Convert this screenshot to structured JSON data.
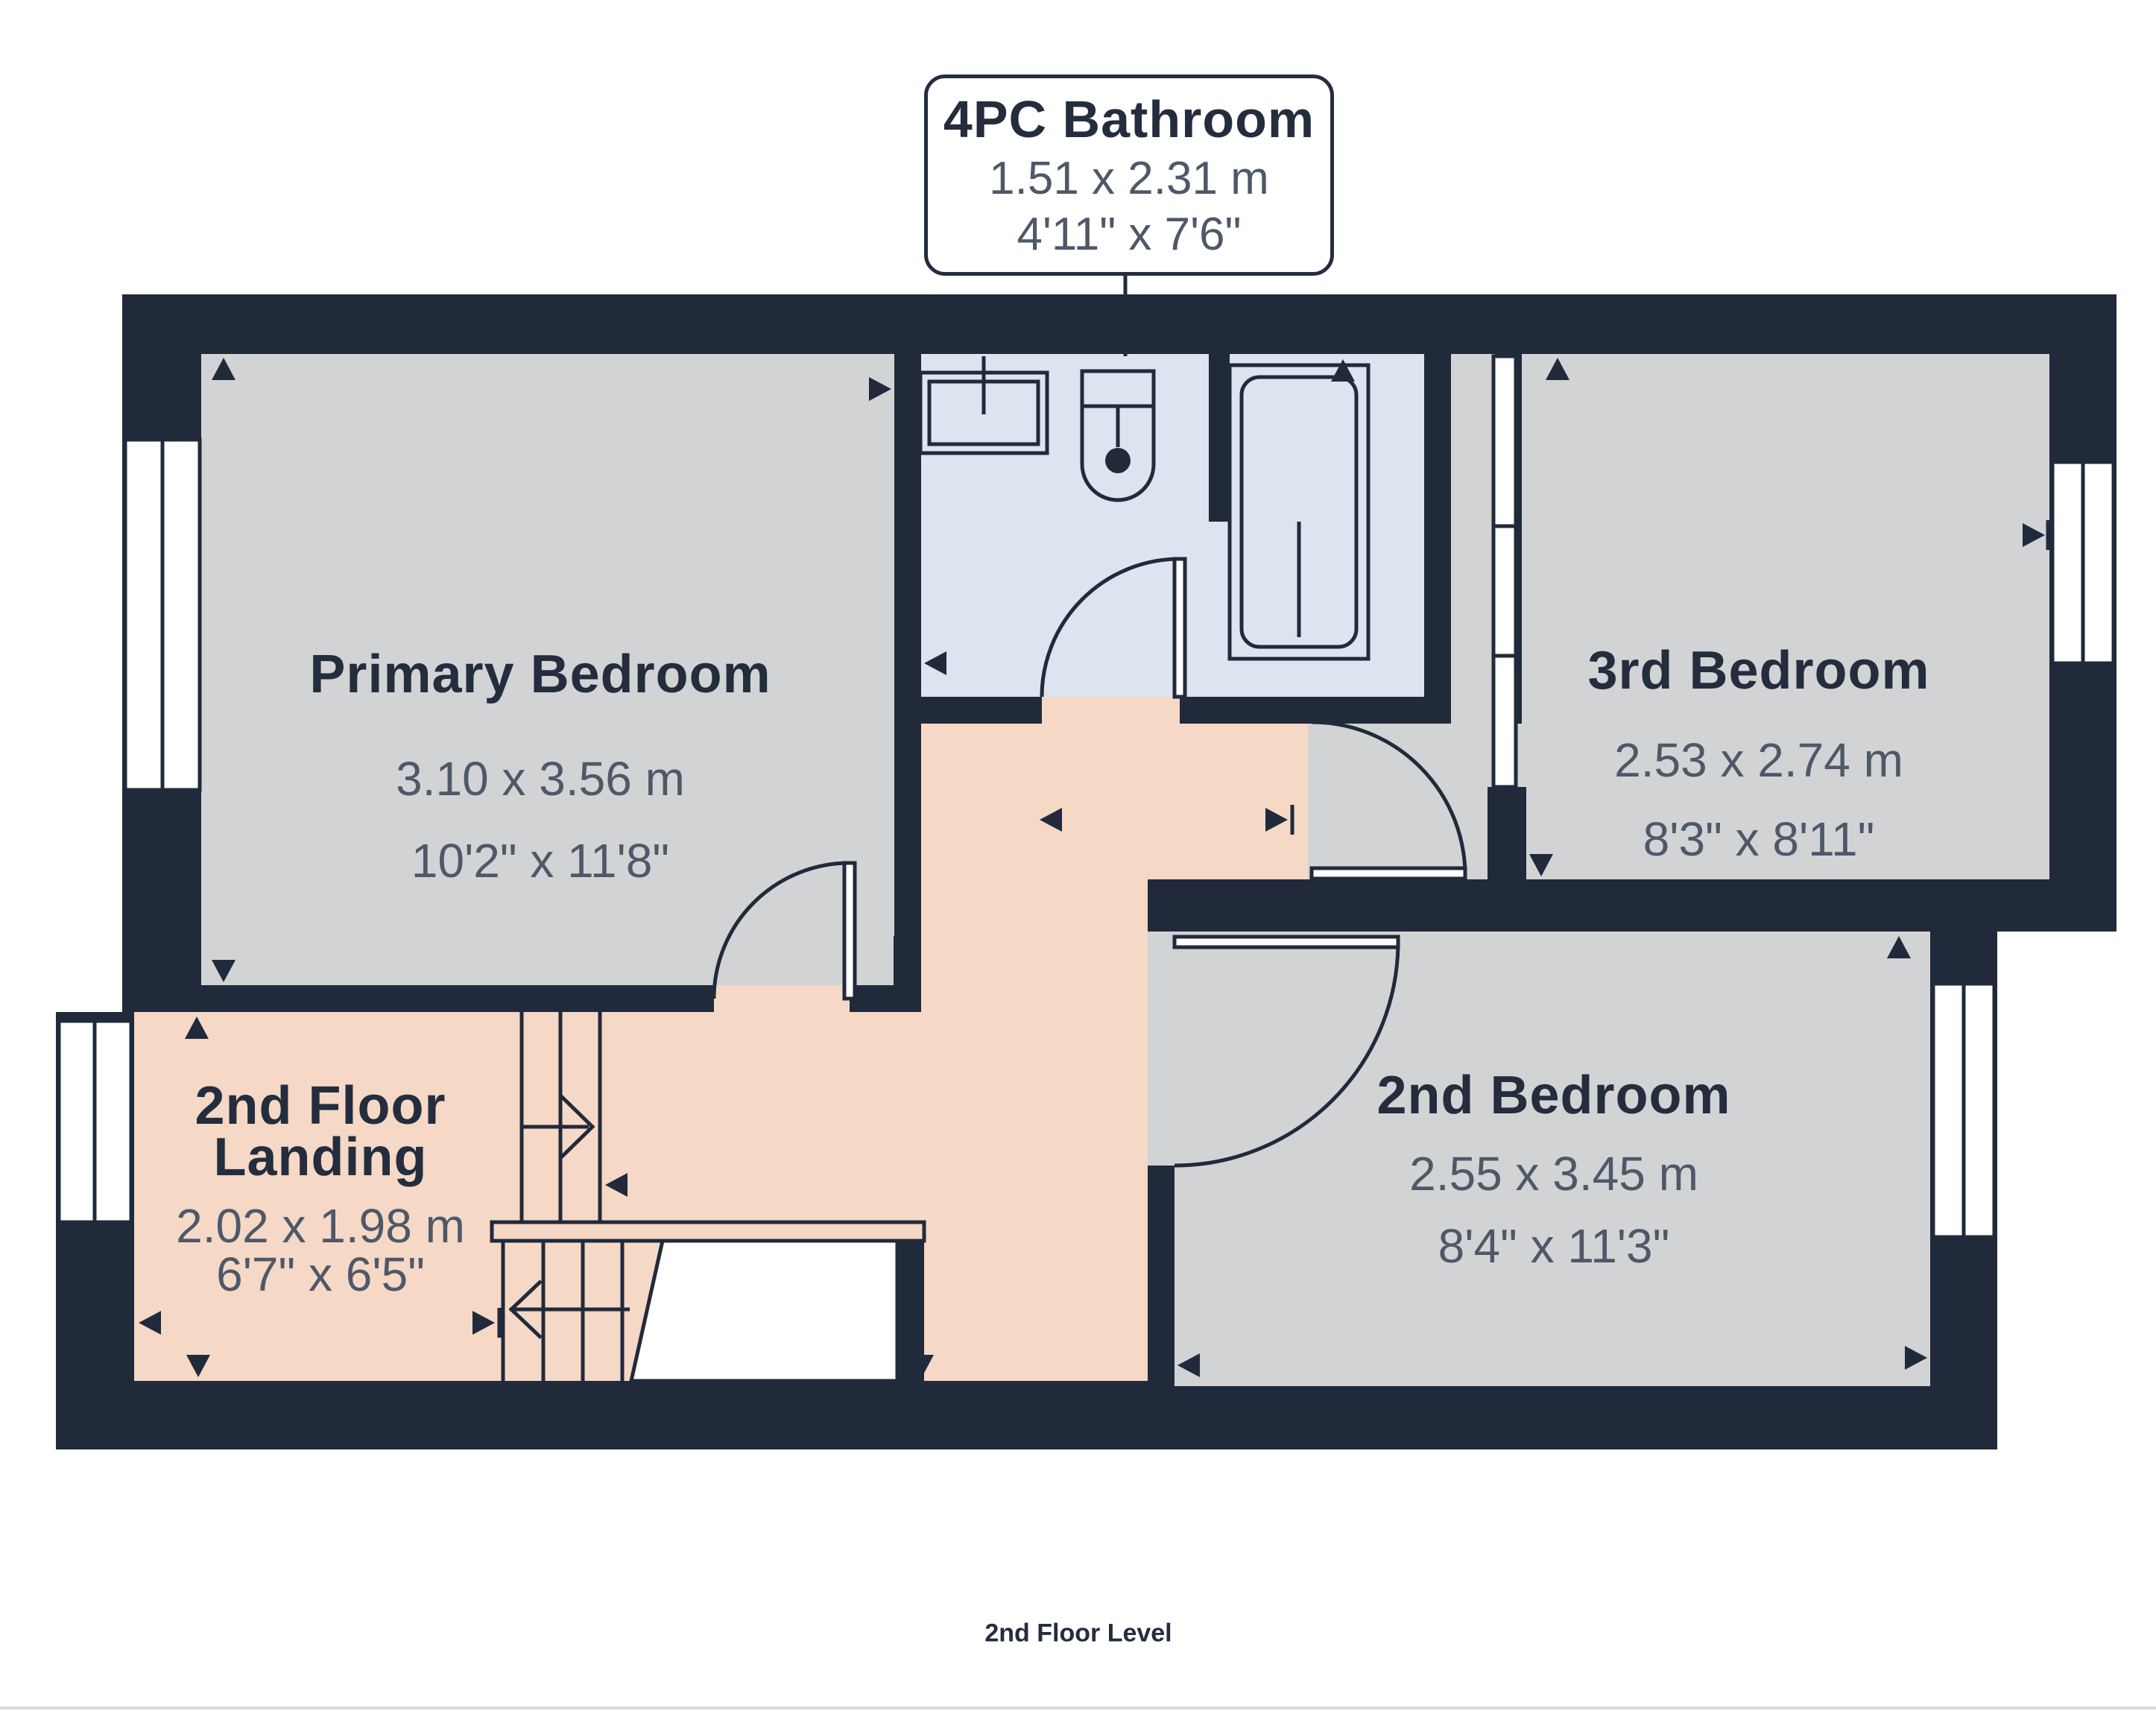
{
  "callout": {
    "title": "4PC Bathroom",
    "dim_metric": "1.51 x 2.31 m",
    "dim_imperial": "4'11\" x 7'6\""
  },
  "rooms": {
    "primary_bedroom": {
      "name": "Primary Bedroom",
      "dim_metric": "3.10 x 3.56 m",
      "dim_imperial": "10'2\" x 11'8\""
    },
    "third_bedroom": {
      "name": "3rd Bedroom",
      "dim_metric": "2.53 x 2.74 m",
      "dim_imperial": "8'3\" x 8'11\""
    },
    "second_bedroom": {
      "name": "2nd Bedroom",
      "dim_metric": "2.55 x 3.45 m",
      "dim_imperial": "8'4\" x 11'3\""
    },
    "landing": {
      "name_line1": "2nd Floor",
      "name_line2": "Landing",
      "dim_metric": "2.02 x 1.98 m",
      "dim_imperial": "6'7\" x 6'5\""
    }
  },
  "caption": "2nd Floor Level",
  "colors": {
    "wall": "#212A3A",
    "floor_bedroom": "#D2D3D4",
    "floor_bathroom": "#DDE3EF",
    "floor_hall": "#F5D8C6",
    "text_title": "#242D3E",
    "text_dim": "#4E5868",
    "divider": "#D9D9D9"
  }
}
